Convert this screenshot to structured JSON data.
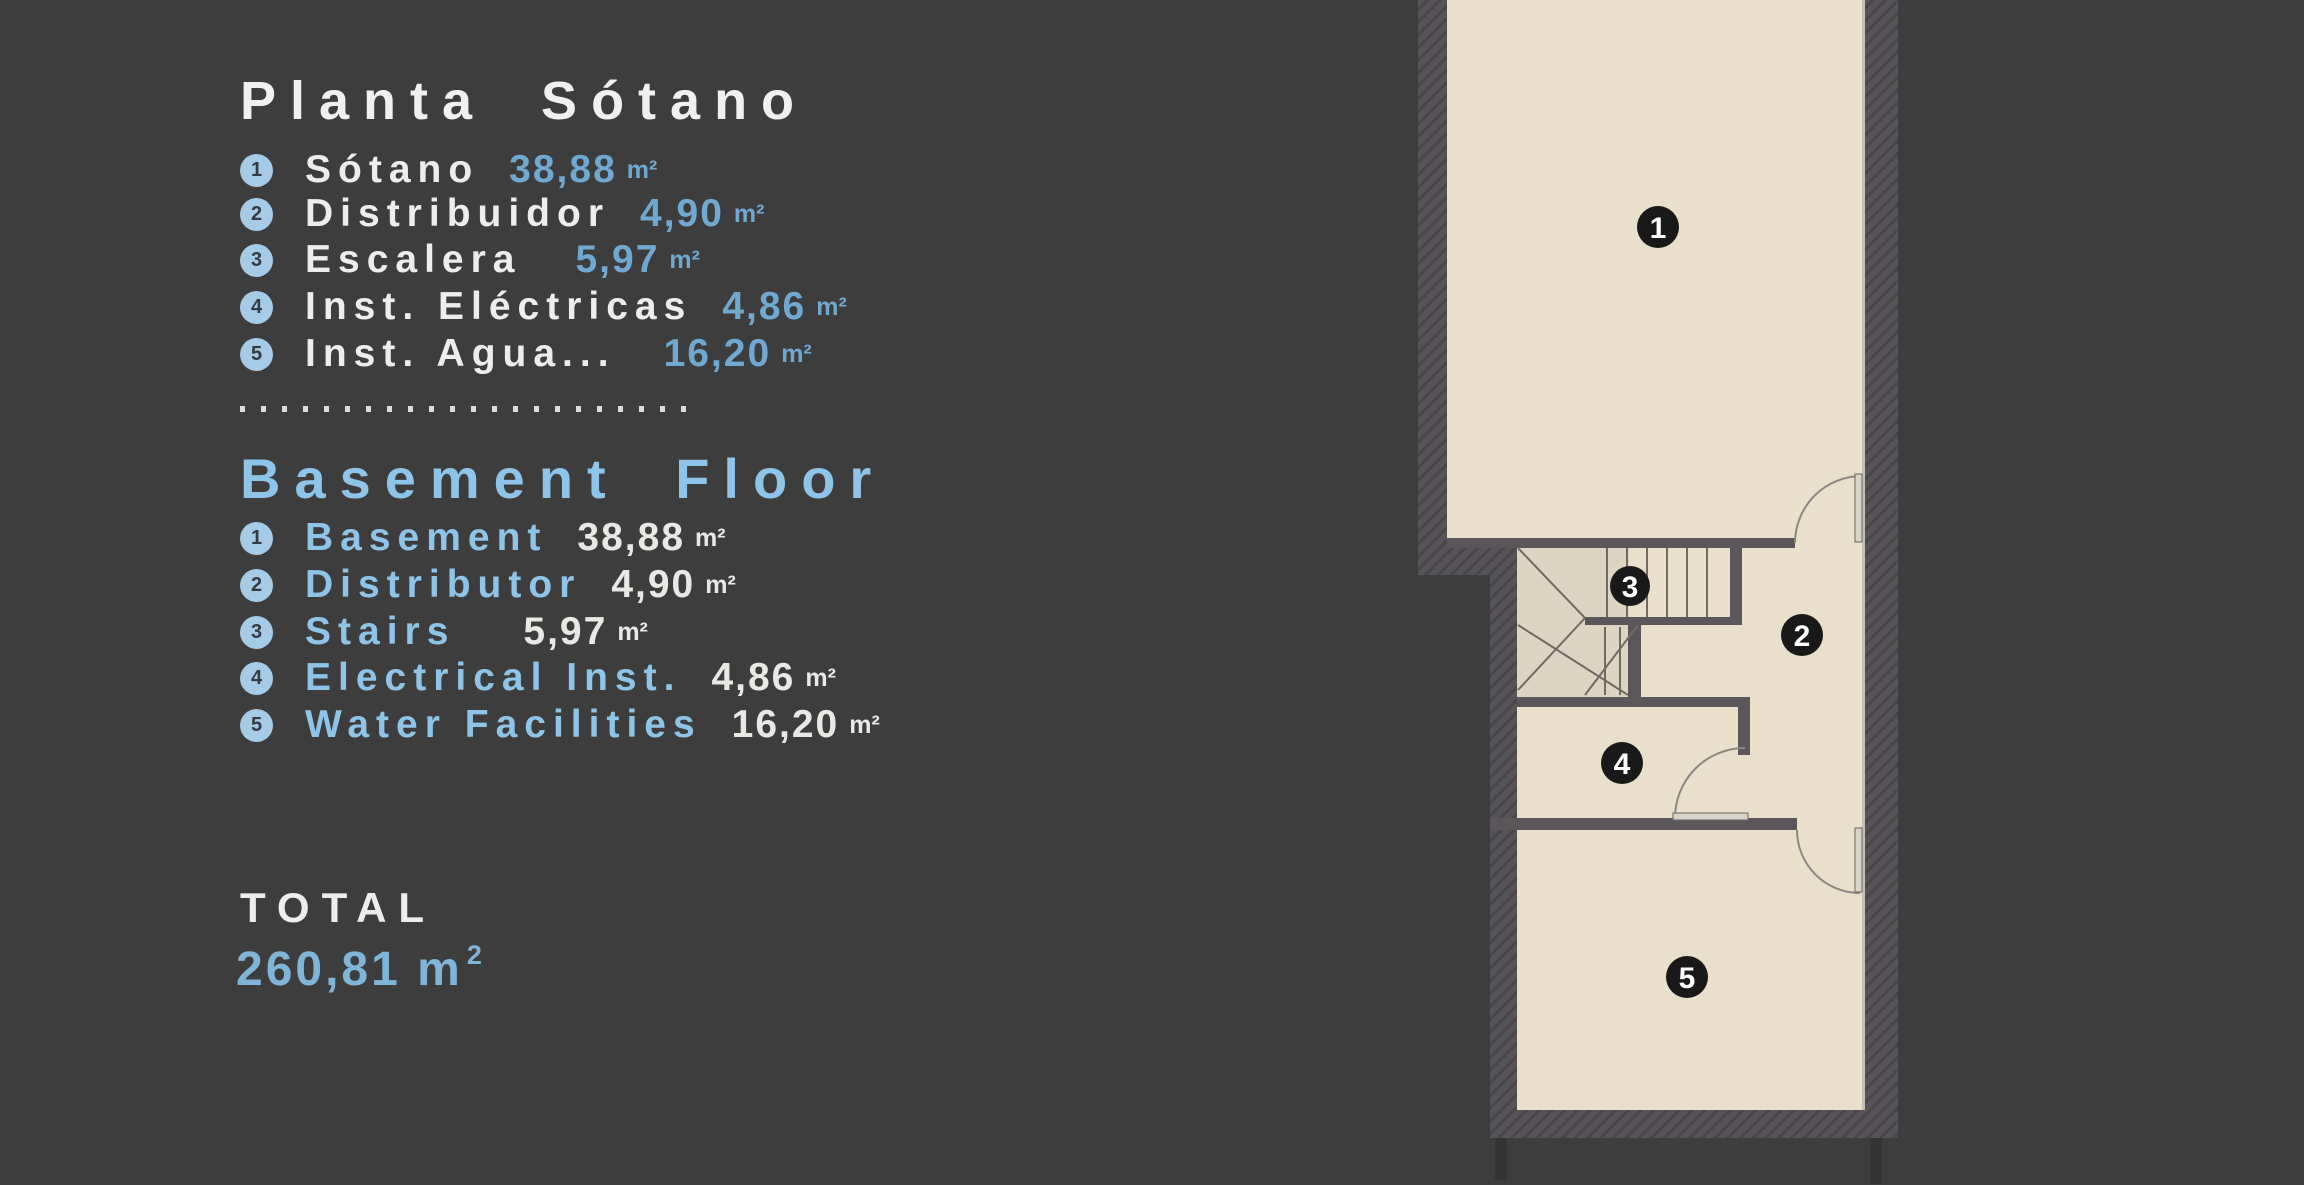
{
  "colors": {
    "background": "#3e3d3e",
    "accent_blue": "#8ec4e8",
    "value_blue": "#6fa9d2",
    "text_white": "#efedeb",
    "floor_beige": "#e9dfcb",
    "wall_gray": "#565359",
    "legend_badge_bg": "#a6cbe7",
    "plan_badge_bg": "#191919"
  },
  "legend_es": {
    "title": "Planta Sótano",
    "items": [
      {
        "num": "1",
        "label": "Sótano",
        "value": "38,88",
        "unit": "m²"
      },
      {
        "num": "2",
        "label": "Distribuidor",
        "value": "4,90",
        "unit": "m²"
      },
      {
        "num": "3",
        "label": "Escalera",
        "value": "5,97",
        "unit": "m²"
      },
      {
        "num": "4",
        "label": "Inst. Eléctricas",
        "value": "4,86",
        "unit": "m²"
      },
      {
        "num": "5",
        "label": "Inst. Agua...",
        "value": "16,20",
        "unit": "m²"
      }
    ]
  },
  "legend_en": {
    "title": "Basement Floor",
    "items": [
      {
        "num": "1",
        "label": "Basement",
        "value": "38,88",
        "unit": "m²"
      },
      {
        "num": "2",
        "label": "Distributor",
        "value": "4,90",
        "unit": "m²"
      },
      {
        "num": "3",
        "label": "Stairs",
        "value": "5,97",
        "unit": "m²"
      },
      {
        "num": "4",
        "label": "Electrical Inst.",
        "value": "4,86",
        "unit": "m²"
      },
      {
        "num": "5",
        "label": "Water Facilities",
        "value": "16,20",
        "unit": "m²"
      }
    ]
  },
  "total": {
    "label": "TOTAL",
    "value": "260,81",
    "unit_base": "m",
    "unit_sup": "2"
  },
  "plan": {
    "badges": [
      {
        "num": "1",
        "room": "basement"
      },
      {
        "num": "2",
        "room": "distributor"
      },
      {
        "num": "3",
        "room": "stairs"
      },
      {
        "num": "4",
        "room": "electrical-inst"
      },
      {
        "num": "5",
        "room": "water-facilities"
      }
    ]
  }
}
